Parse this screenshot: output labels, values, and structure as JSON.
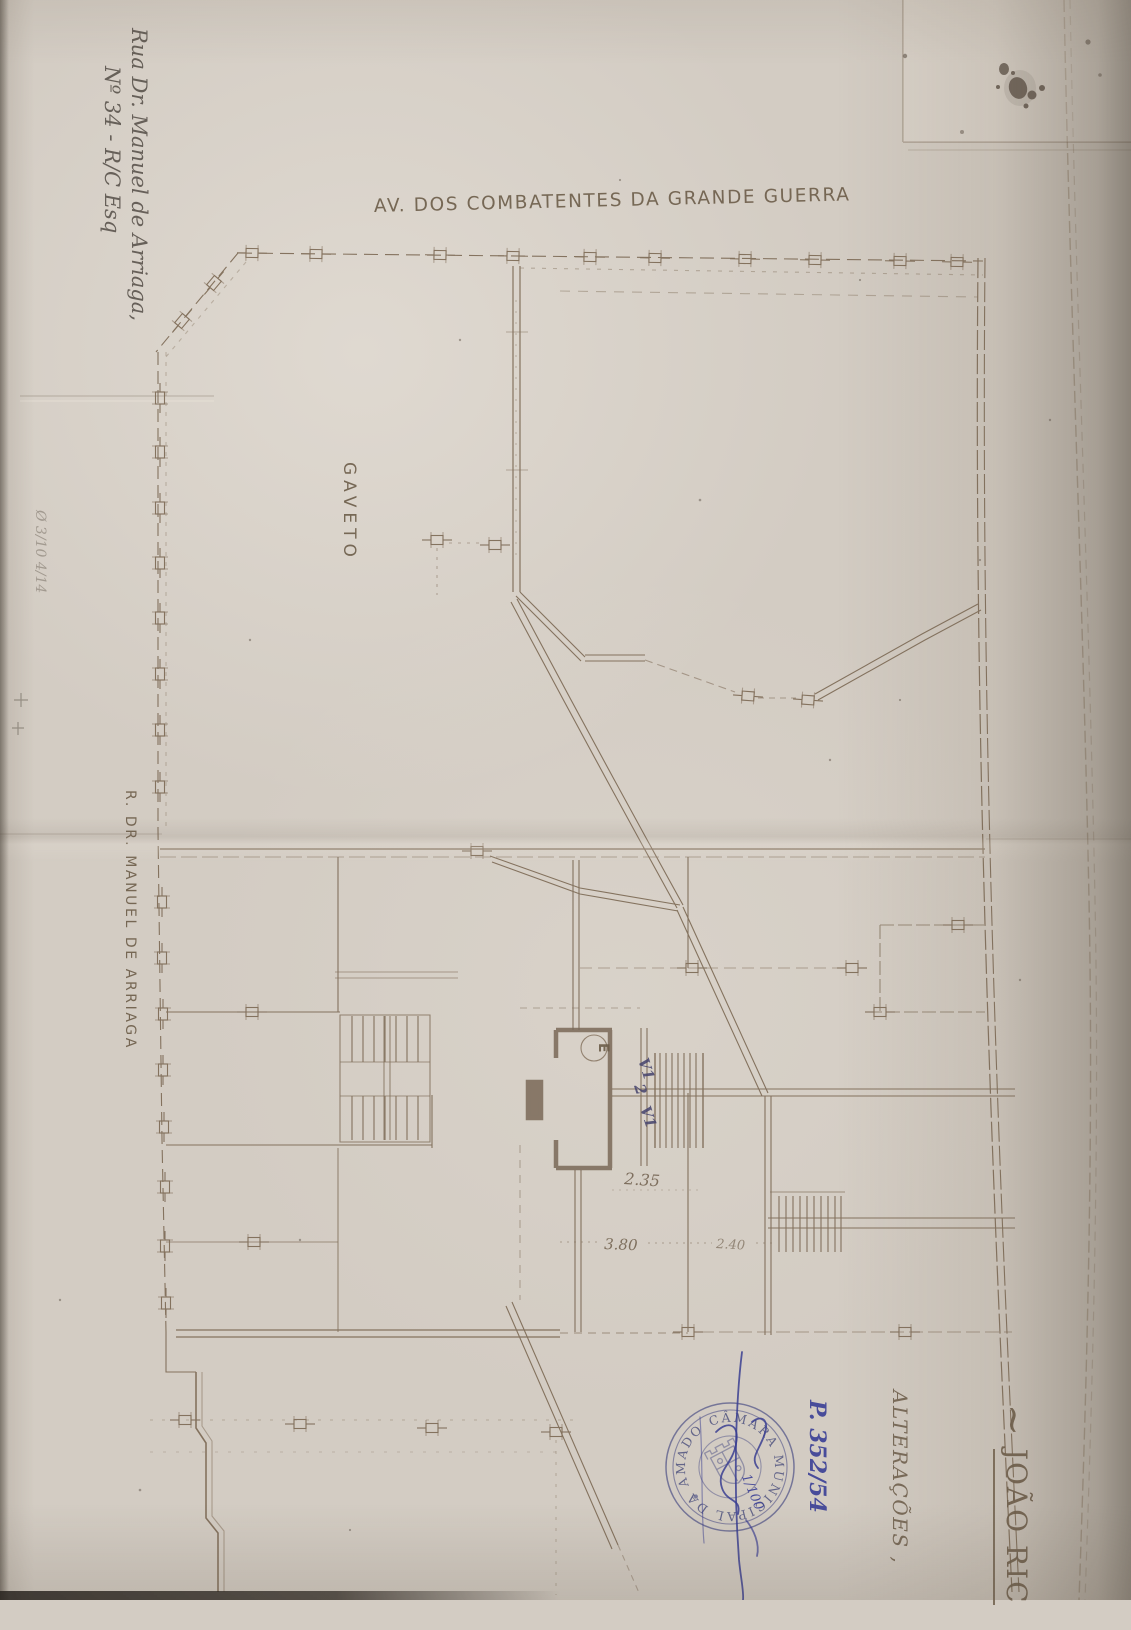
{
  "colors": {
    "paper": "#d3ccc3",
    "plan_ink": "#7b6853",
    "pencil": "#56504a",
    "blue_ink": "#3c3f8f",
    "stamp_blue": "#565890"
  },
  "margin_notes": {
    "address_line1": "Rua Dr. Manuel de Arriaga,",
    "address_line2": "Nº 34 - R/C Esq",
    "faint_note": "Ø 3/10 4/14"
  },
  "plan_labels": {
    "avenue": "AV. DOS COMBATENTES DA GRANDE GUERRA",
    "corner": "GAVETO",
    "street": "R. DR. MANUEL DE ARRIAGA",
    "elevator": "E",
    "window_upper": "V1",
    "unit_number": "2",
    "window_lower": "V1"
  },
  "dimensions": {
    "d1": "2.35",
    "d2": "3.80",
    "d3": "2.40"
  },
  "title_block": {
    "tilde": "~",
    "owner_name": "JOÃO RIC",
    "alterations": "ALTERAÇÕES ,"
  },
  "stamp": {
    "ring_text": "CÂMARA MUNICIPAL DA AMADORA",
    "process_number": "P. 352/54",
    "overlay_note": "1/100"
  }
}
